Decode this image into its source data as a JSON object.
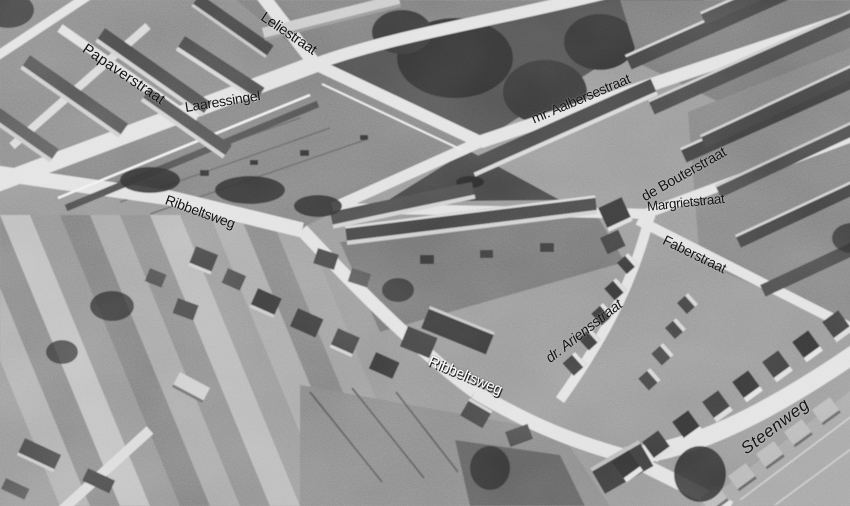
{
  "photo": {
    "description": "Black-and-white aerial photograph of the Ribbeltsweg neighbourhood with street names annotated over the image",
    "label_color": "#141414",
    "inverse_label_color": "#ffffff",
    "palette": {
      "ground": "#8d8d8d",
      "roads": "#dedede",
      "roofs_dark": "#3e3e3e",
      "park_trees": "#2b2b2b",
      "walls_light": "#d2d2d2"
    }
  },
  "street_labels": [
    {
      "id": "papaverstraat",
      "text": "Papaverstraat"
    },
    {
      "id": "leliestraat",
      "text": "Leliestraat"
    },
    {
      "id": "laaressingel",
      "text": "Laaressingel"
    },
    {
      "id": "mr-aalbersestraat",
      "text": "mr. Aalbersestraat"
    },
    {
      "id": "de-bouterstraat",
      "text": "de Bouterstraat"
    },
    {
      "id": "margrietstraat",
      "text": "Margrietstraat"
    },
    {
      "id": "faberstraat",
      "text": "Faberstraat"
    },
    {
      "id": "ribbeltsweg-west",
      "text": "Ribbeltsweg"
    },
    {
      "id": "ribbeltsweg-south",
      "text": "Ribbeltsweg"
    },
    {
      "id": "dr-ariensstraat",
      "text": "dr. Ariensstraat"
    },
    {
      "id": "steenweg",
      "text": "Steenweg"
    }
  ]
}
